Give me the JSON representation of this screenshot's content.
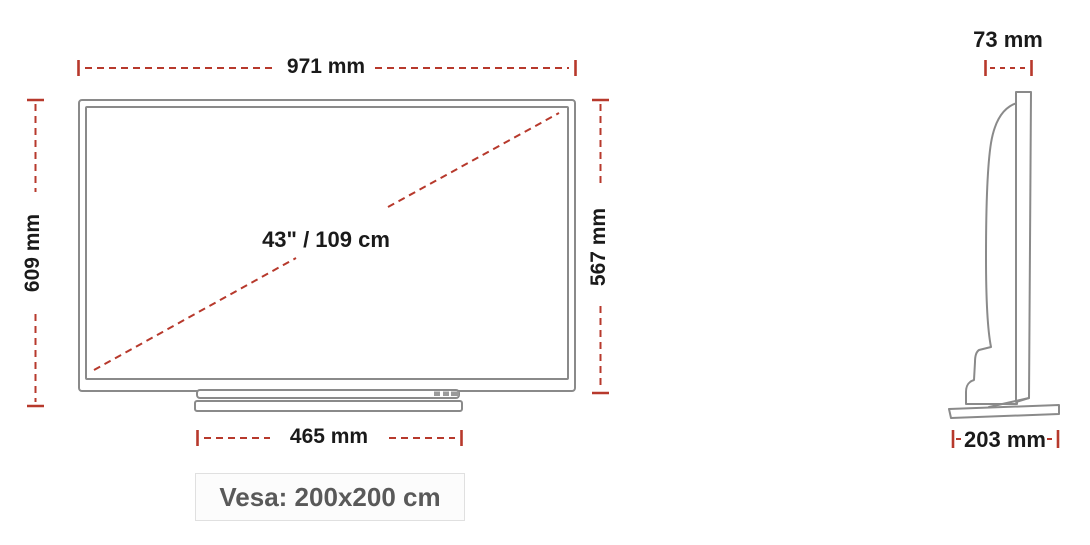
{
  "title": "TV dimensions diagram",
  "colors": {
    "dimension_red": "#b7392c",
    "outline_gray": "#8a8a8a",
    "label_black": "#1a1a1a",
    "vesa_text": "#595959",
    "vesa_bg": "#fcfcfc",
    "vesa_border": "#e0e0e0",
    "canvas_bg": "#ffffff"
  },
  "front_view": {
    "width_label": "971 mm",
    "height_left_label": "609 mm",
    "height_right_label": "567 mm",
    "diagonal_label": "43\" / 109 cm",
    "stand_width_label": "465 mm",
    "vesa_label": "Vesa: 200x200 cm"
  },
  "side_view": {
    "depth_top_label": "73 mm",
    "depth_base_label": "203 mm"
  }
}
